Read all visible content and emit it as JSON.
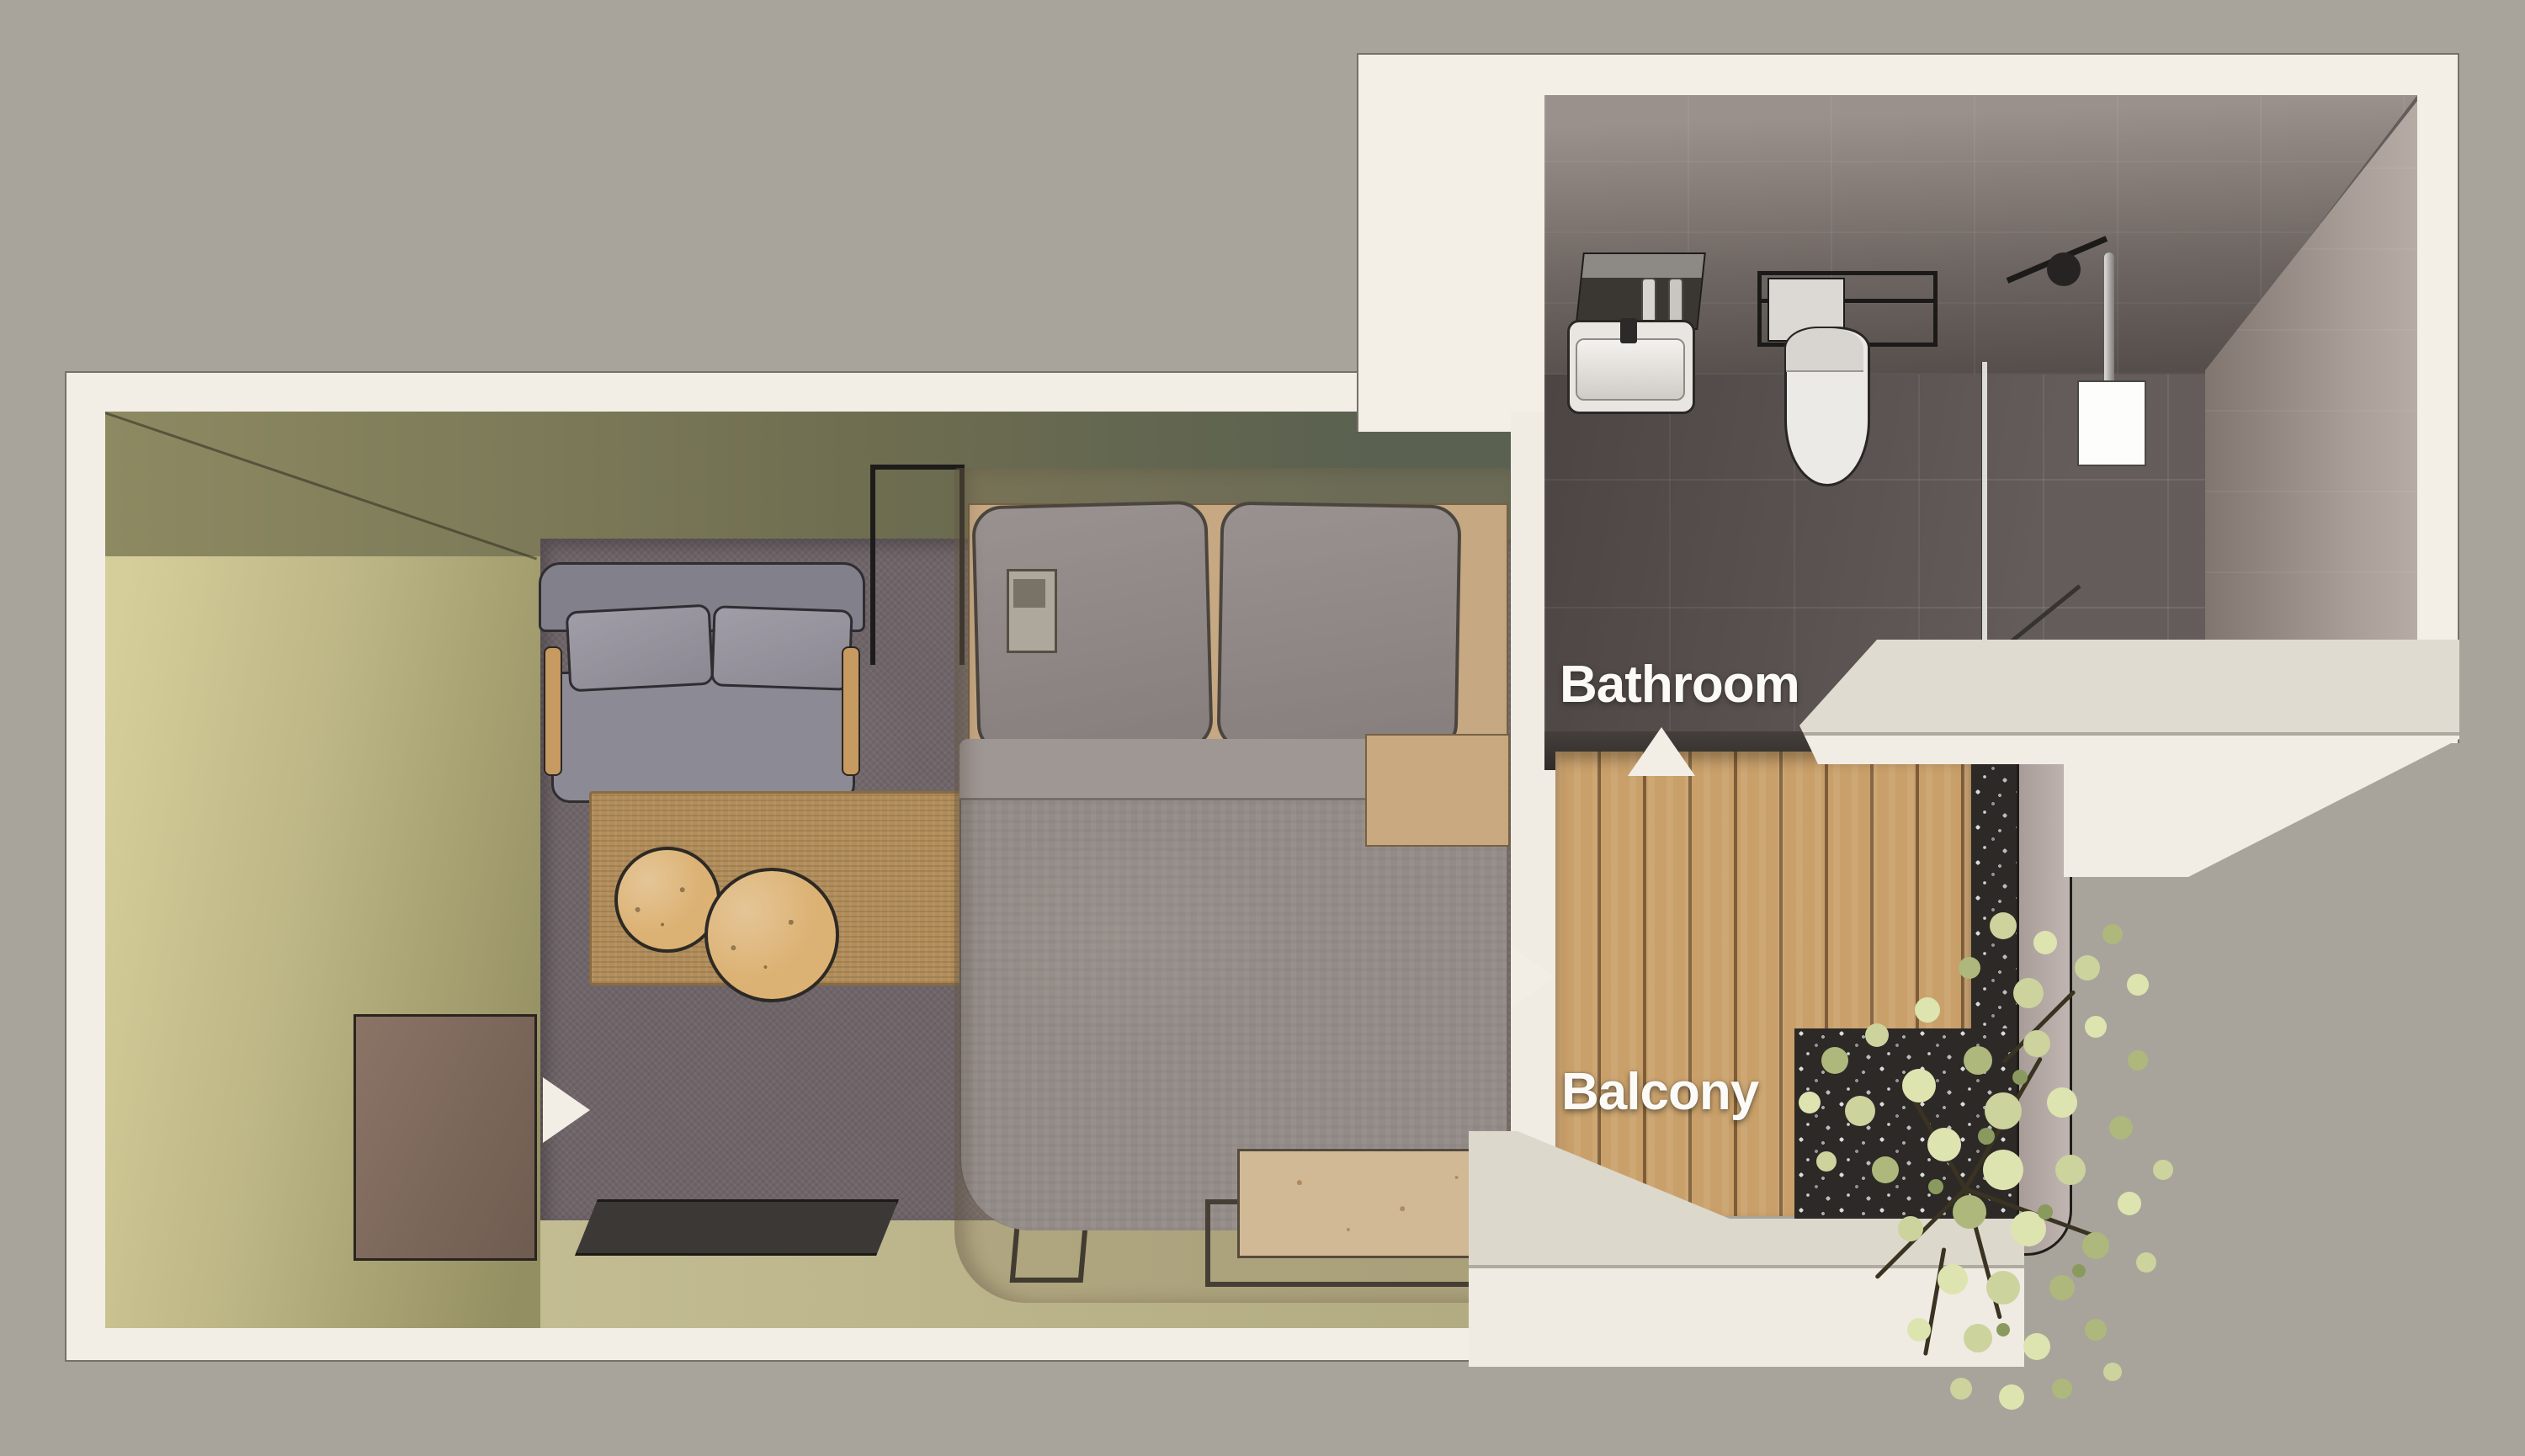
{
  "scene": {
    "type": "3d-floorplan-top-view",
    "description": "Top-down 3D rendering of a hotel guest room with bedroom, en-suite bathroom and balcony",
    "background_color": "#a8a49b",
    "wall_color": "#f2eee6"
  },
  "labels": {
    "bathroom": "Bathroom",
    "balcony": "Balcony"
  },
  "arrows": [
    {
      "name": "bathroom-entry-arrow",
      "direction": "up",
      "target": "bathroom"
    },
    {
      "name": "balcony-entry-arrow",
      "direction": "right",
      "target": "balcony"
    },
    {
      "name": "room-entry-arrow",
      "direction": "right",
      "target": "bedroom"
    }
  ],
  "rooms": {
    "bedroom": {
      "furniture": [
        "sofa",
        "coffee-table-small",
        "coffee-table-large",
        "jute-rug",
        "entry-door",
        "doormat",
        "glass-partition",
        "double-bed",
        "pillows",
        "wood-headboard",
        "telephone",
        "duvet",
        "nightstand",
        "foot-bench",
        "glass-enclosure"
      ]
    },
    "bathroom": {
      "fixtures": [
        "vanity-mirror-shelf",
        "toiletry-bottles",
        "sink",
        "faucet",
        "towel-rack",
        "towel",
        "toilet",
        "shower-glass-panel",
        "shower-arm",
        "shower-head",
        "shower-pipe",
        "shower-niche",
        "squeegee"
      ]
    },
    "balcony": {
      "features": [
        "wood-deck",
        "gravel-bed",
        "tree-plant",
        "railing",
        "ledge-wall"
      ]
    }
  },
  "palette": {
    "carpet": "#6f6569",
    "khaki_wall": "#beb786",
    "olive_top_wall": "#6e6d50",
    "rug": "#b28d5a",
    "sofa": "#8c8a94",
    "duvet": "#938f97",
    "wood_deck": "#c9a06a",
    "gravel": "#2c2927",
    "bath_tile": "#5e5654",
    "plant_leaf": "#ccd39d",
    "label_text": "#fbfaf7",
    "arrow": "#f3eee5"
  }
}
